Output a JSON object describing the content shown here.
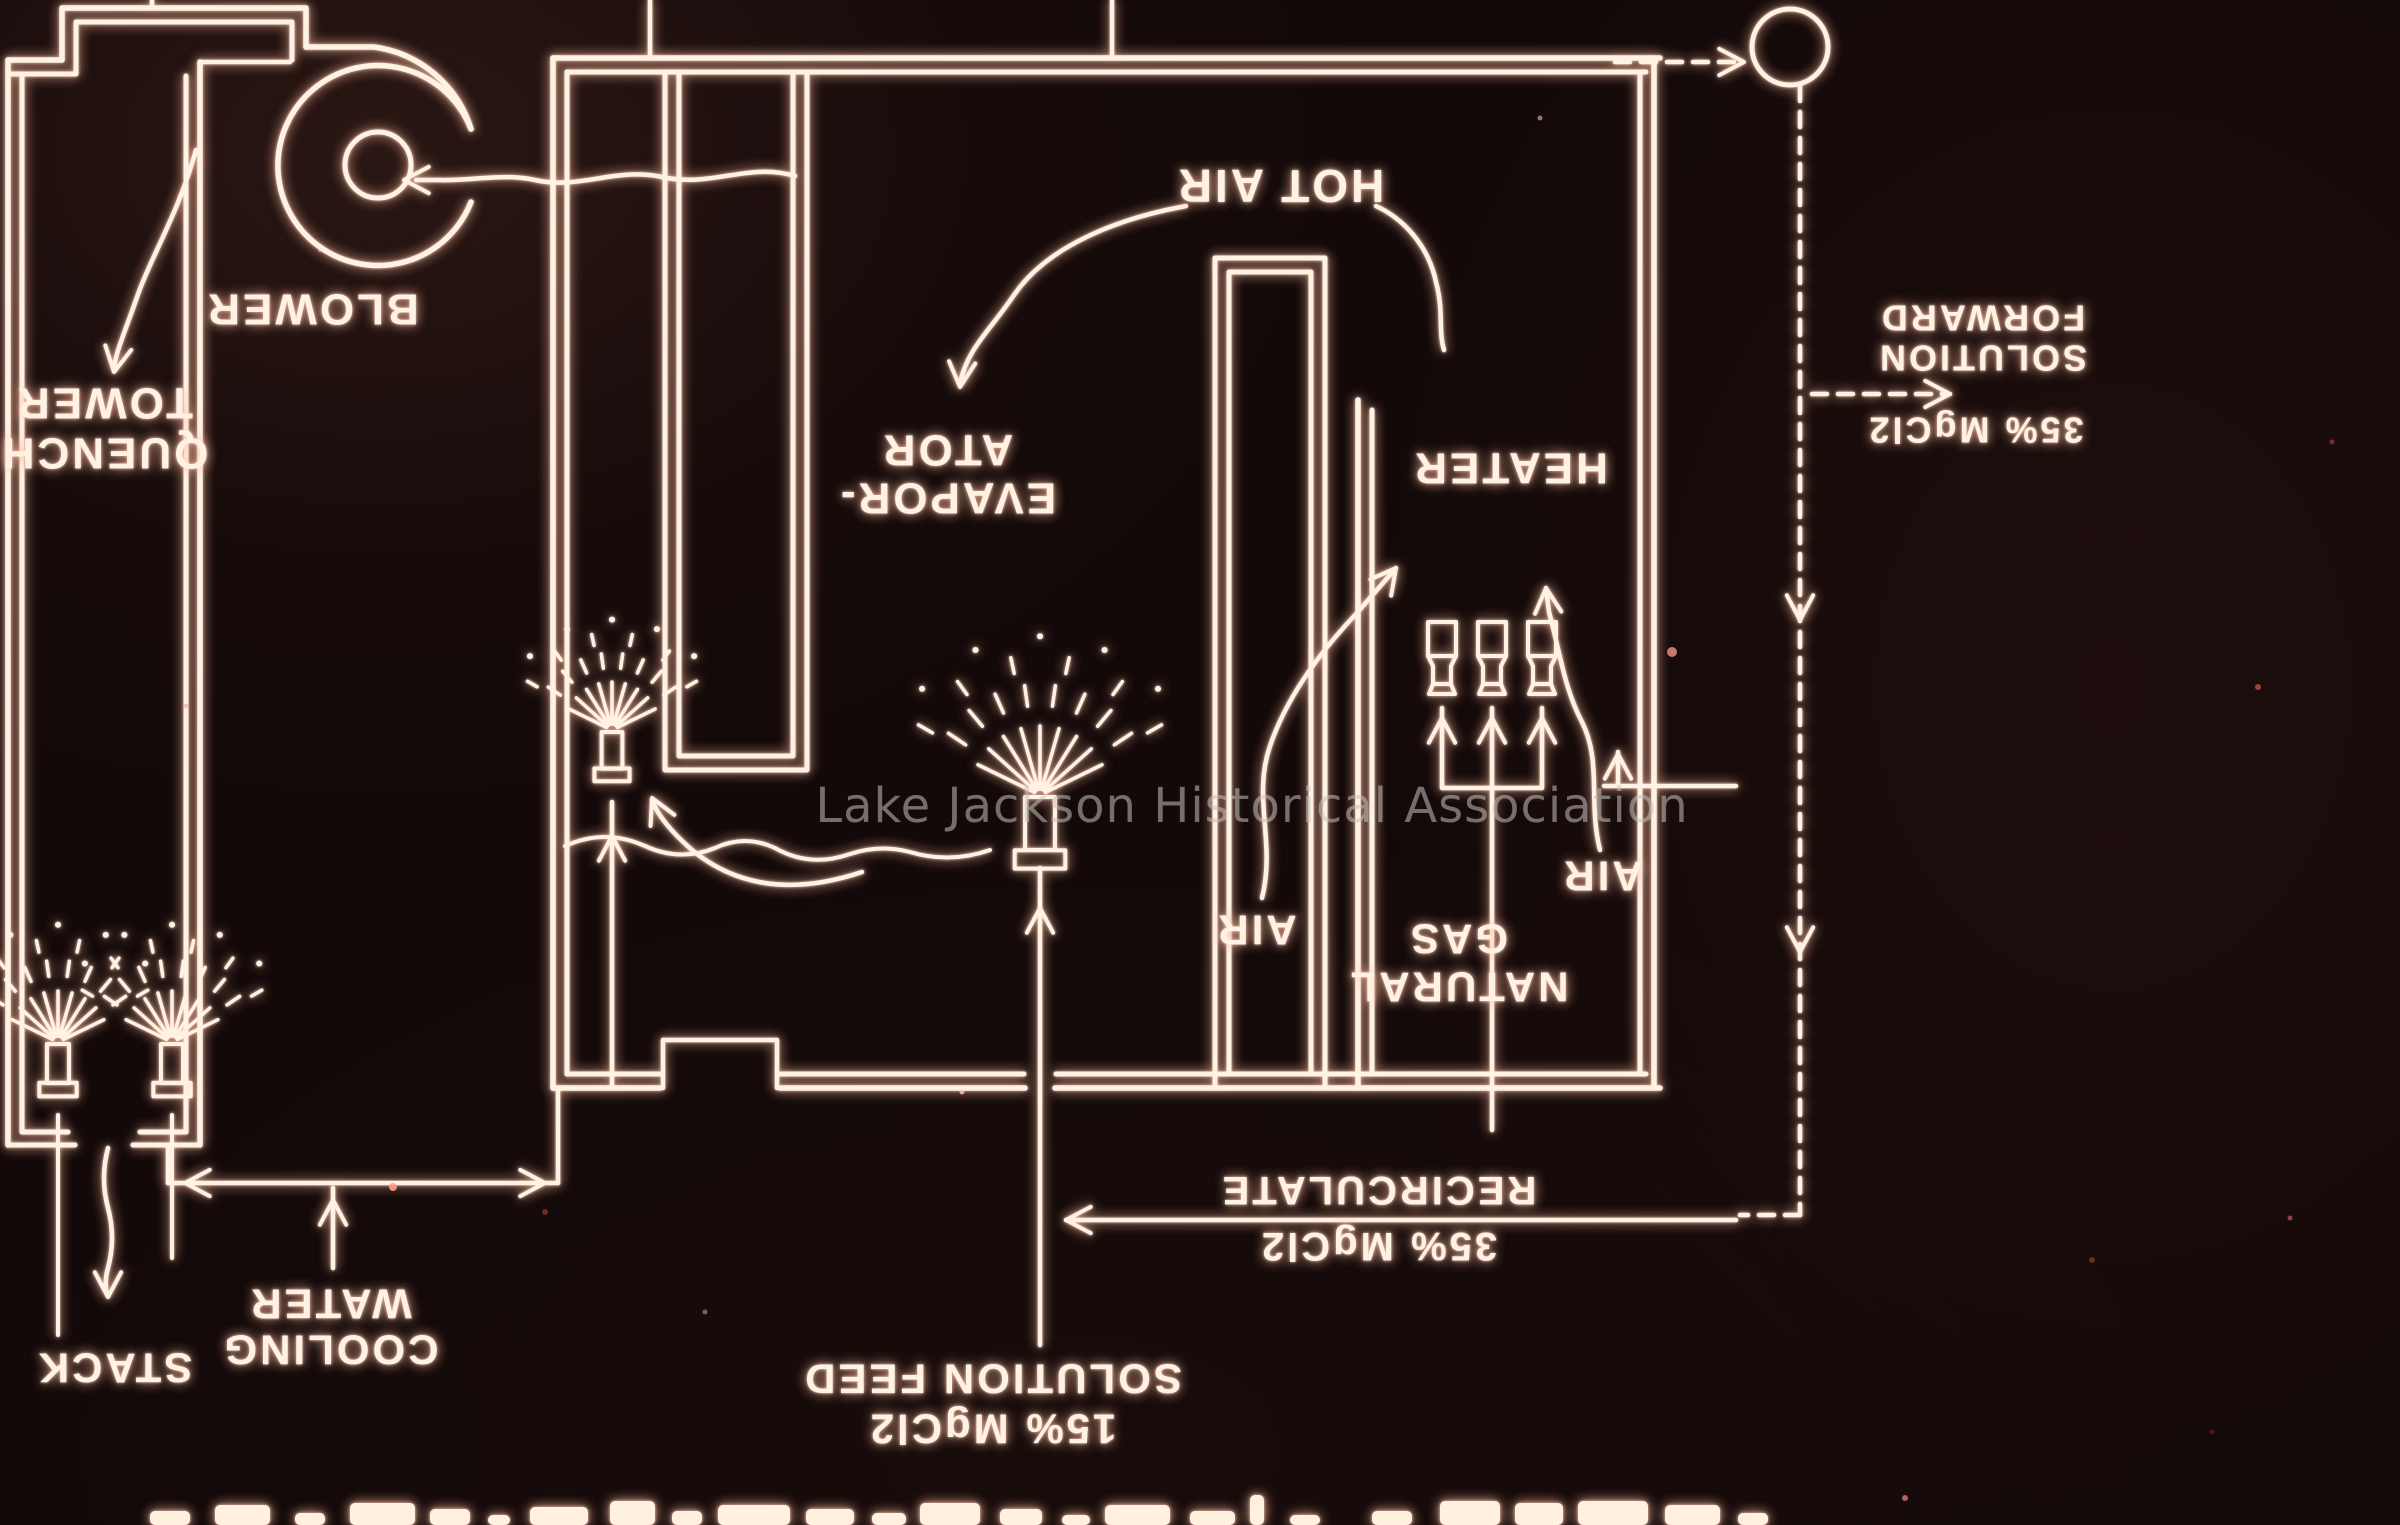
{
  "watermark": {
    "text": "Lake Jackson Historical Association"
  },
  "colors": {
    "background": "#130909",
    "line": "#fff2e4",
    "glow": "#ff9a6c",
    "watermark": "#c6c2be",
    "dust_speck": "#e98a7e"
  },
  "orientation_note": "slide photographed upside down - all labels rotated 180 degrees",
  "labels": [
    {
      "id": "quench-tower",
      "x": 104,
      "y": 428,
      "fs": 44,
      "lh": 50,
      "lines": [
        "QUENCH",
        "TOWER"
      ]
    },
    {
      "id": "blower",
      "x": 312,
      "y": 309,
      "fs": 44,
      "lh": 0,
      "lines": [
        "BLOWER"
      ]
    },
    {
      "id": "hot-air",
      "x": 1280,
      "y": 186,
      "fs": 46,
      "lh": 0,
      "lines": [
        "HOT AIR"
      ]
    },
    {
      "id": "evaporator",
      "x": 947,
      "y": 474,
      "fs": 44,
      "lh": 48,
      "lines": [
        "EVAPOR-",
        "ATOR"
      ]
    },
    {
      "id": "heater",
      "x": 1510,
      "y": 468,
      "fs": 44,
      "lh": 0,
      "lines": [
        "HEATER"
      ]
    },
    {
      "id": "air-left",
      "x": 1256,
      "y": 930,
      "fs": 42,
      "lh": 0,
      "lines": [
        "AIR"
      ]
    },
    {
      "id": "air-right",
      "x": 1602,
      "y": 876,
      "fs": 42,
      "lh": 0,
      "lines": [
        "AIR"
      ]
    },
    {
      "id": "natural-gas",
      "x": 1458,
      "y": 963,
      "fs": 42,
      "lh": 48,
      "lines": [
        "NATURAL",
        "GAS"
      ]
    },
    {
      "id": "solution-forward",
      "x": 1982,
      "y": 338,
      "fs": 36,
      "lh": 40,
      "lines": [
        "SOLUTION",
        "FORWARD"
      ]
    },
    {
      "id": "forward-concentration",
      "x": 1975,
      "y": 430,
      "fs": 36,
      "lh": 0,
      "lines": [
        "35% MgCl2"
      ]
    },
    {
      "id": "recirculate",
      "x": 1378,
      "y": 1218,
      "fs": 40,
      "lh": 56,
      "lines": [
        "35% MgCl2",
        "RECIRCULATE"
      ]
    },
    {
      "id": "solution-feed",
      "x": 992,
      "y": 1404,
      "fs": 42,
      "lh": 50,
      "lines": [
        "15% MgCl2",
        "SOLUTION FEED"
      ]
    },
    {
      "id": "cooling-water",
      "x": 330,
      "y": 1327,
      "fs": 42,
      "lh": 46,
      "lines": [
        "COOLING",
        "WATER"
      ]
    },
    {
      "id": "stack",
      "x": 114,
      "y": 1368,
      "fs": 42,
      "lh": 0,
      "lines": [
        "STACK"
      ]
    }
  ]
}
